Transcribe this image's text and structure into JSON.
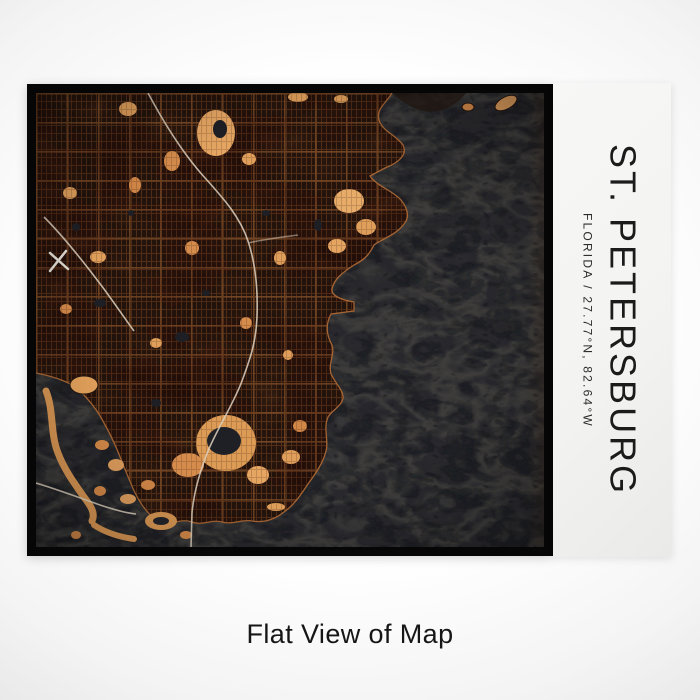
{
  "page": {
    "caption": "Flat View of Map",
    "background_center": "#ffffff",
    "background_edge": "#cecece"
  },
  "print": {
    "panel": {
      "title": "ST. PETERSBURG",
      "subtitle": "FLORIDA / 27.77°N, 82.64°W",
      "subtitle_parts": {
        "state": "FLORIDA",
        "latitude": "27.77°N",
        "longitude": "82.64°W"
      },
      "background": "#f4f4f2",
      "text_color": "#1b1b1b"
    },
    "map": {
      "frame_color": "#060606",
      "land_color": "#2b1810",
      "street_color": "#96572c",
      "major_street_color": "#c77c3e",
      "highlight_color": "#e8a55e",
      "water_color": "#26262b",
      "water_vein_light": "#52504a",
      "water_vein_dark": "#0d0e11",
      "highway_color": "#e6d9c6"
    }
  }
}
